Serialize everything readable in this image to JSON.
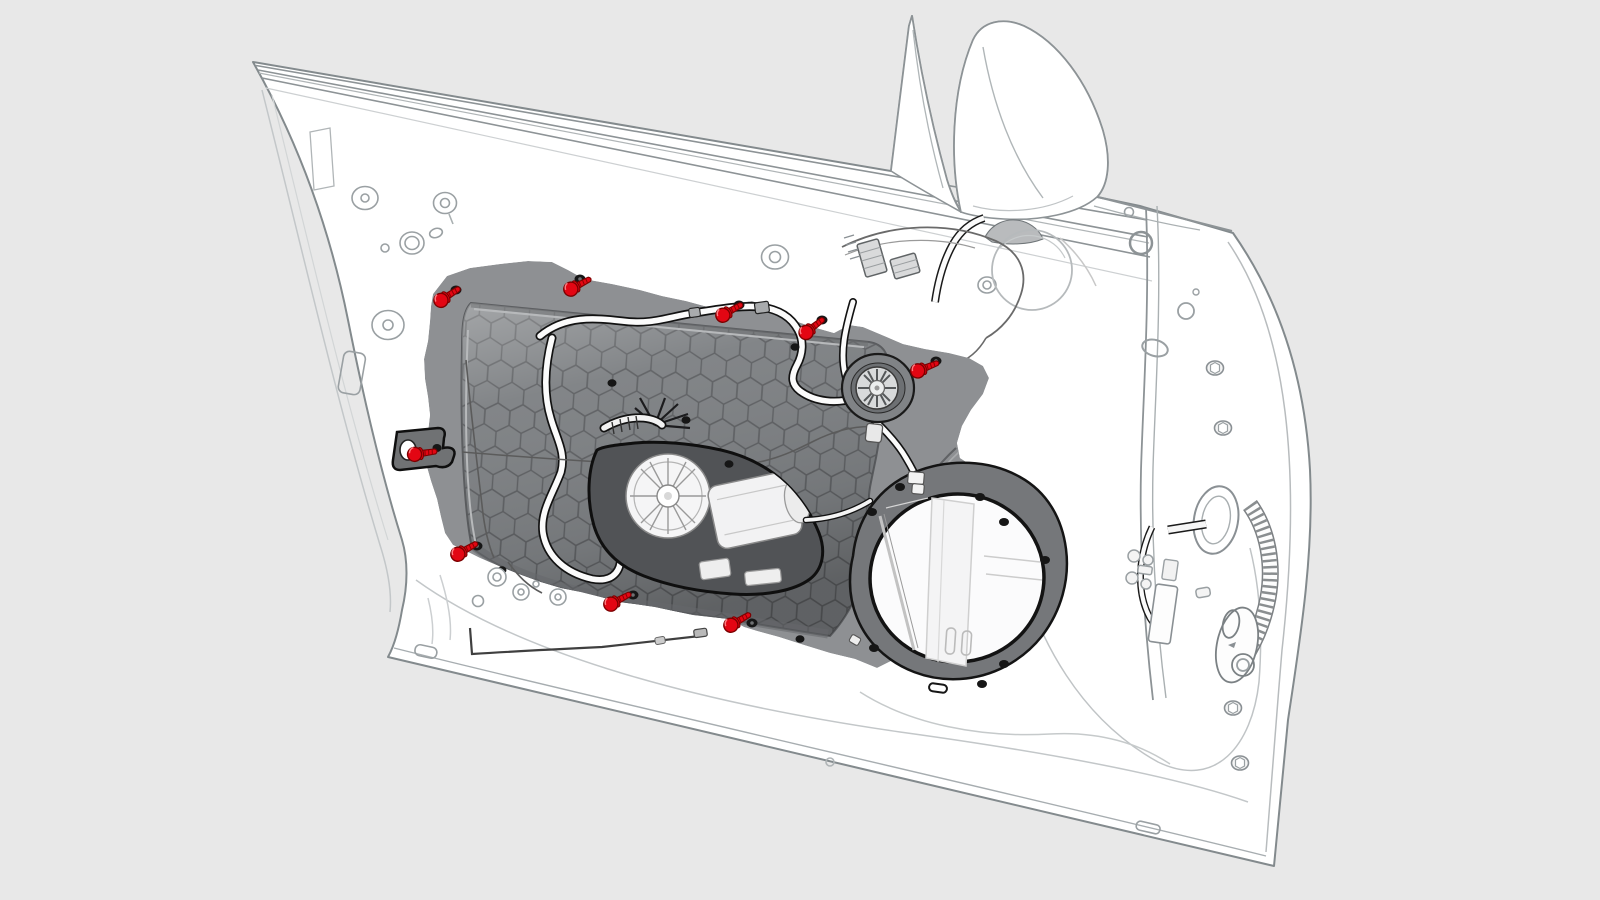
{
  "canvas": {
    "width": 1600,
    "height": 900,
    "background": "#e8e8e8"
  },
  "illustration": {
    "type": "vehicle-service-diagram",
    "subject": "front-door-carrier-module-fastener-locations",
    "style": "monochrome-line-art-with-red-highlighted-fasteners",
    "colors": {
      "background": "#e8e8e8",
      "door_fill": "#ffffff",
      "door_line": "#8d9396",
      "soft_line": "#c3c7c9",
      "panel_fill": "#8e9093",
      "panel_recess": "#7d8083",
      "hex_line": "#5d5f62",
      "panel_outline": "#141414",
      "flange_fill": "#75777a",
      "opening_fill": "#515356",
      "highlight_red": "#e30613",
      "highlight_red_dark": "#7c0000"
    },
    "parts": [
      "door-shell",
      "window-beltline-rails",
      "mirror-sail-panel",
      "side-mirror-housing",
      "a-pillar-frame",
      "door-carrier-module",
      "honeycomb-core-panel",
      "window-regulator-motor",
      "wiring-harness-tubes",
      "bowden-cables",
      "tweeter-speaker-mount",
      "woofer-speaker-opening",
      "speaker-flange",
      "door-check-bracket",
      "hinge-grommets",
      "door-handle-backing-circle",
      "harness-connectors",
      "door-latch-hardware",
      "harness-coil-boot",
      "drain-wire",
      "trim-grommets"
    ]
  },
  "fasteners": {
    "count": 9,
    "color": "#e30613",
    "outline": "#7c0000",
    "thread_color": "#8c0000",
    "glint": "#ff7a80",
    "items": [
      {
        "id": "screw-1",
        "x": 443,
        "y": 299,
        "angle": -33
      },
      {
        "id": "screw-2",
        "x": 573,
        "y": 288,
        "angle": -28
      },
      {
        "id": "screw-3",
        "x": 725,
        "y": 314,
        "angle": -30
      },
      {
        "id": "screw-4",
        "x": 808,
        "y": 331,
        "angle": -38
      },
      {
        "id": "screw-5",
        "x": 920,
        "y": 370,
        "angle": -22
      },
      {
        "id": "screw-6",
        "x": 417,
        "y": 454,
        "angle": -8
      },
      {
        "id": "screw-7",
        "x": 460,
        "y": 553,
        "angle": -30
      },
      {
        "id": "screw-8",
        "x": 613,
        "y": 603,
        "angle": -28
      },
      {
        "id": "screw-9",
        "x": 733,
        "y": 624,
        "angle": -30
      }
    ]
  }
}
